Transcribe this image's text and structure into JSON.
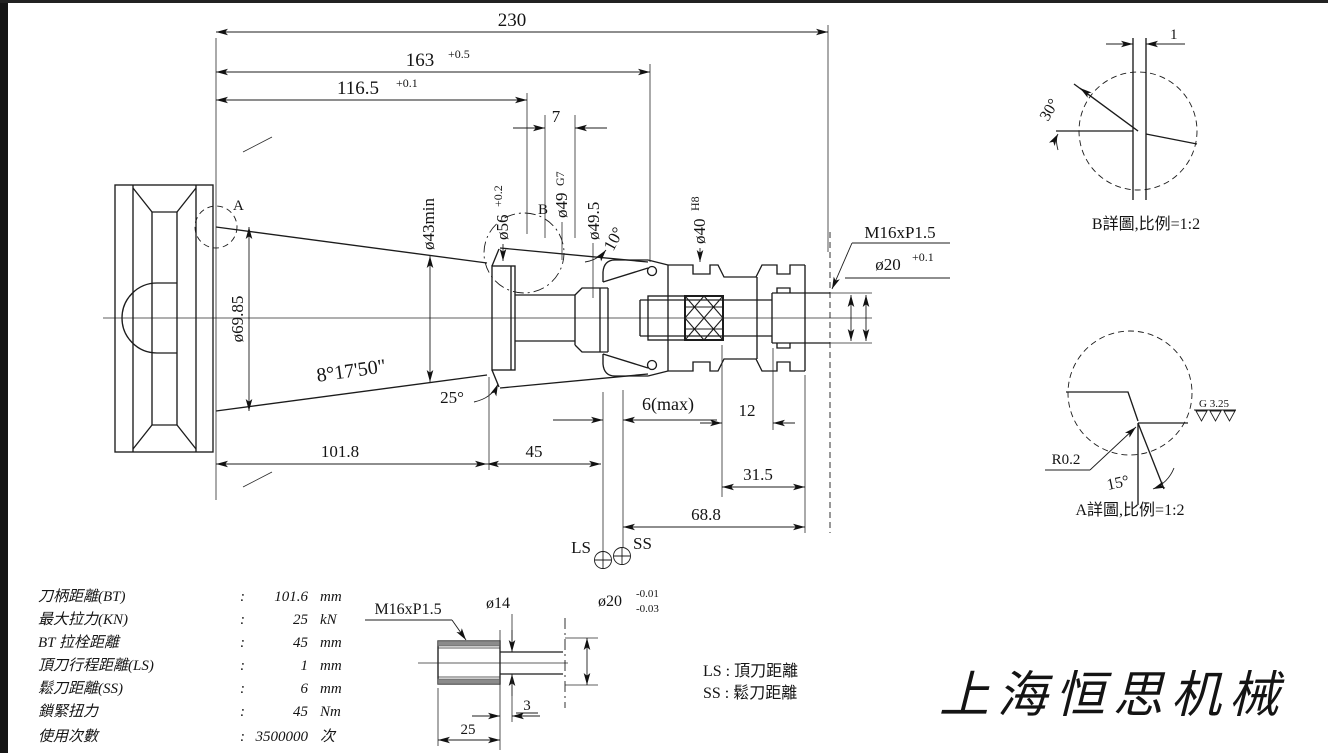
{
  "main_view": {
    "dims": {
      "d230": "230",
      "d163": "163",
      "d163_tol": "+0.5",
      "d116_5": "116.5",
      "d116_5_tol": "+0.1",
      "d7": "7",
      "d43min": "ø43min",
      "d56": "ø56",
      "d56_tol": "+0.2",
      "d49": "ø49",
      "d49_fit": "G7",
      "d49_5": "ø49.5",
      "a10": "10°",
      "d40": "ø40",
      "d40_fit": "H8",
      "d69_85": "ø69.85",
      "taper_angle": "8°17'50\"",
      "a25": "25°",
      "d101_8": "101.8",
      "d45": "45",
      "d6max": "6(max)",
      "d12": "12",
      "d31_5": "31.5",
      "d68_8": "68.8",
      "m16": "M16xP1.5",
      "d20": "ø20",
      "d20_tol": "+0.1",
      "ls": "LS",
      "ss": "SS",
      "mark_a": "A",
      "mark_b": "B"
    }
  },
  "detail_b": {
    "caption": "B詳圖,比例=1:2",
    "angle": "30°",
    "width": "1"
  },
  "detail_a": {
    "caption": "A詳圖,比例=1:2",
    "radius": "R0.2",
    "angle": "15°",
    "roughness": "G 3.25"
  },
  "stud_view": {
    "thread": "M16xP1.5",
    "d14": "ø14",
    "d20": "ø20",
    "tol_upper": "-0.01",
    "tol_lower": "-0.03",
    "len25": "25",
    "len3": "3"
  },
  "spec_table": {
    "rows": [
      {
        "label": "刀柄距離(BT)",
        "colon": ":",
        "value": "101.6",
        "unit": "mm"
      },
      {
        "label": "最大拉力(KN)",
        "colon": ":",
        "value": "25",
        "unit": "kN"
      },
      {
        "label": "BT 拉栓距離",
        "colon": ":",
        "value": "45",
        "unit": "mm"
      },
      {
        "label": "頂刀行程距離(LS)",
        "colon": ":",
        "value": "1",
        "unit": "mm"
      },
      {
        "label": "鬆刀距離(SS)",
        "colon": ":",
        "value": "6",
        "unit": "mm"
      },
      {
        "label": "鎖緊扭力",
        "colon": ":",
        "value": "45",
        "unit": "Nm"
      },
      {
        "label": "使用次數",
        "colon": ":",
        "value": "3500000",
        "unit": "次"
      }
    ]
  },
  "legend": {
    "ls": "LS :  頂刀距離",
    "ss": "SS :  鬆刀距離"
  },
  "company": "上海恒思机械"
}
